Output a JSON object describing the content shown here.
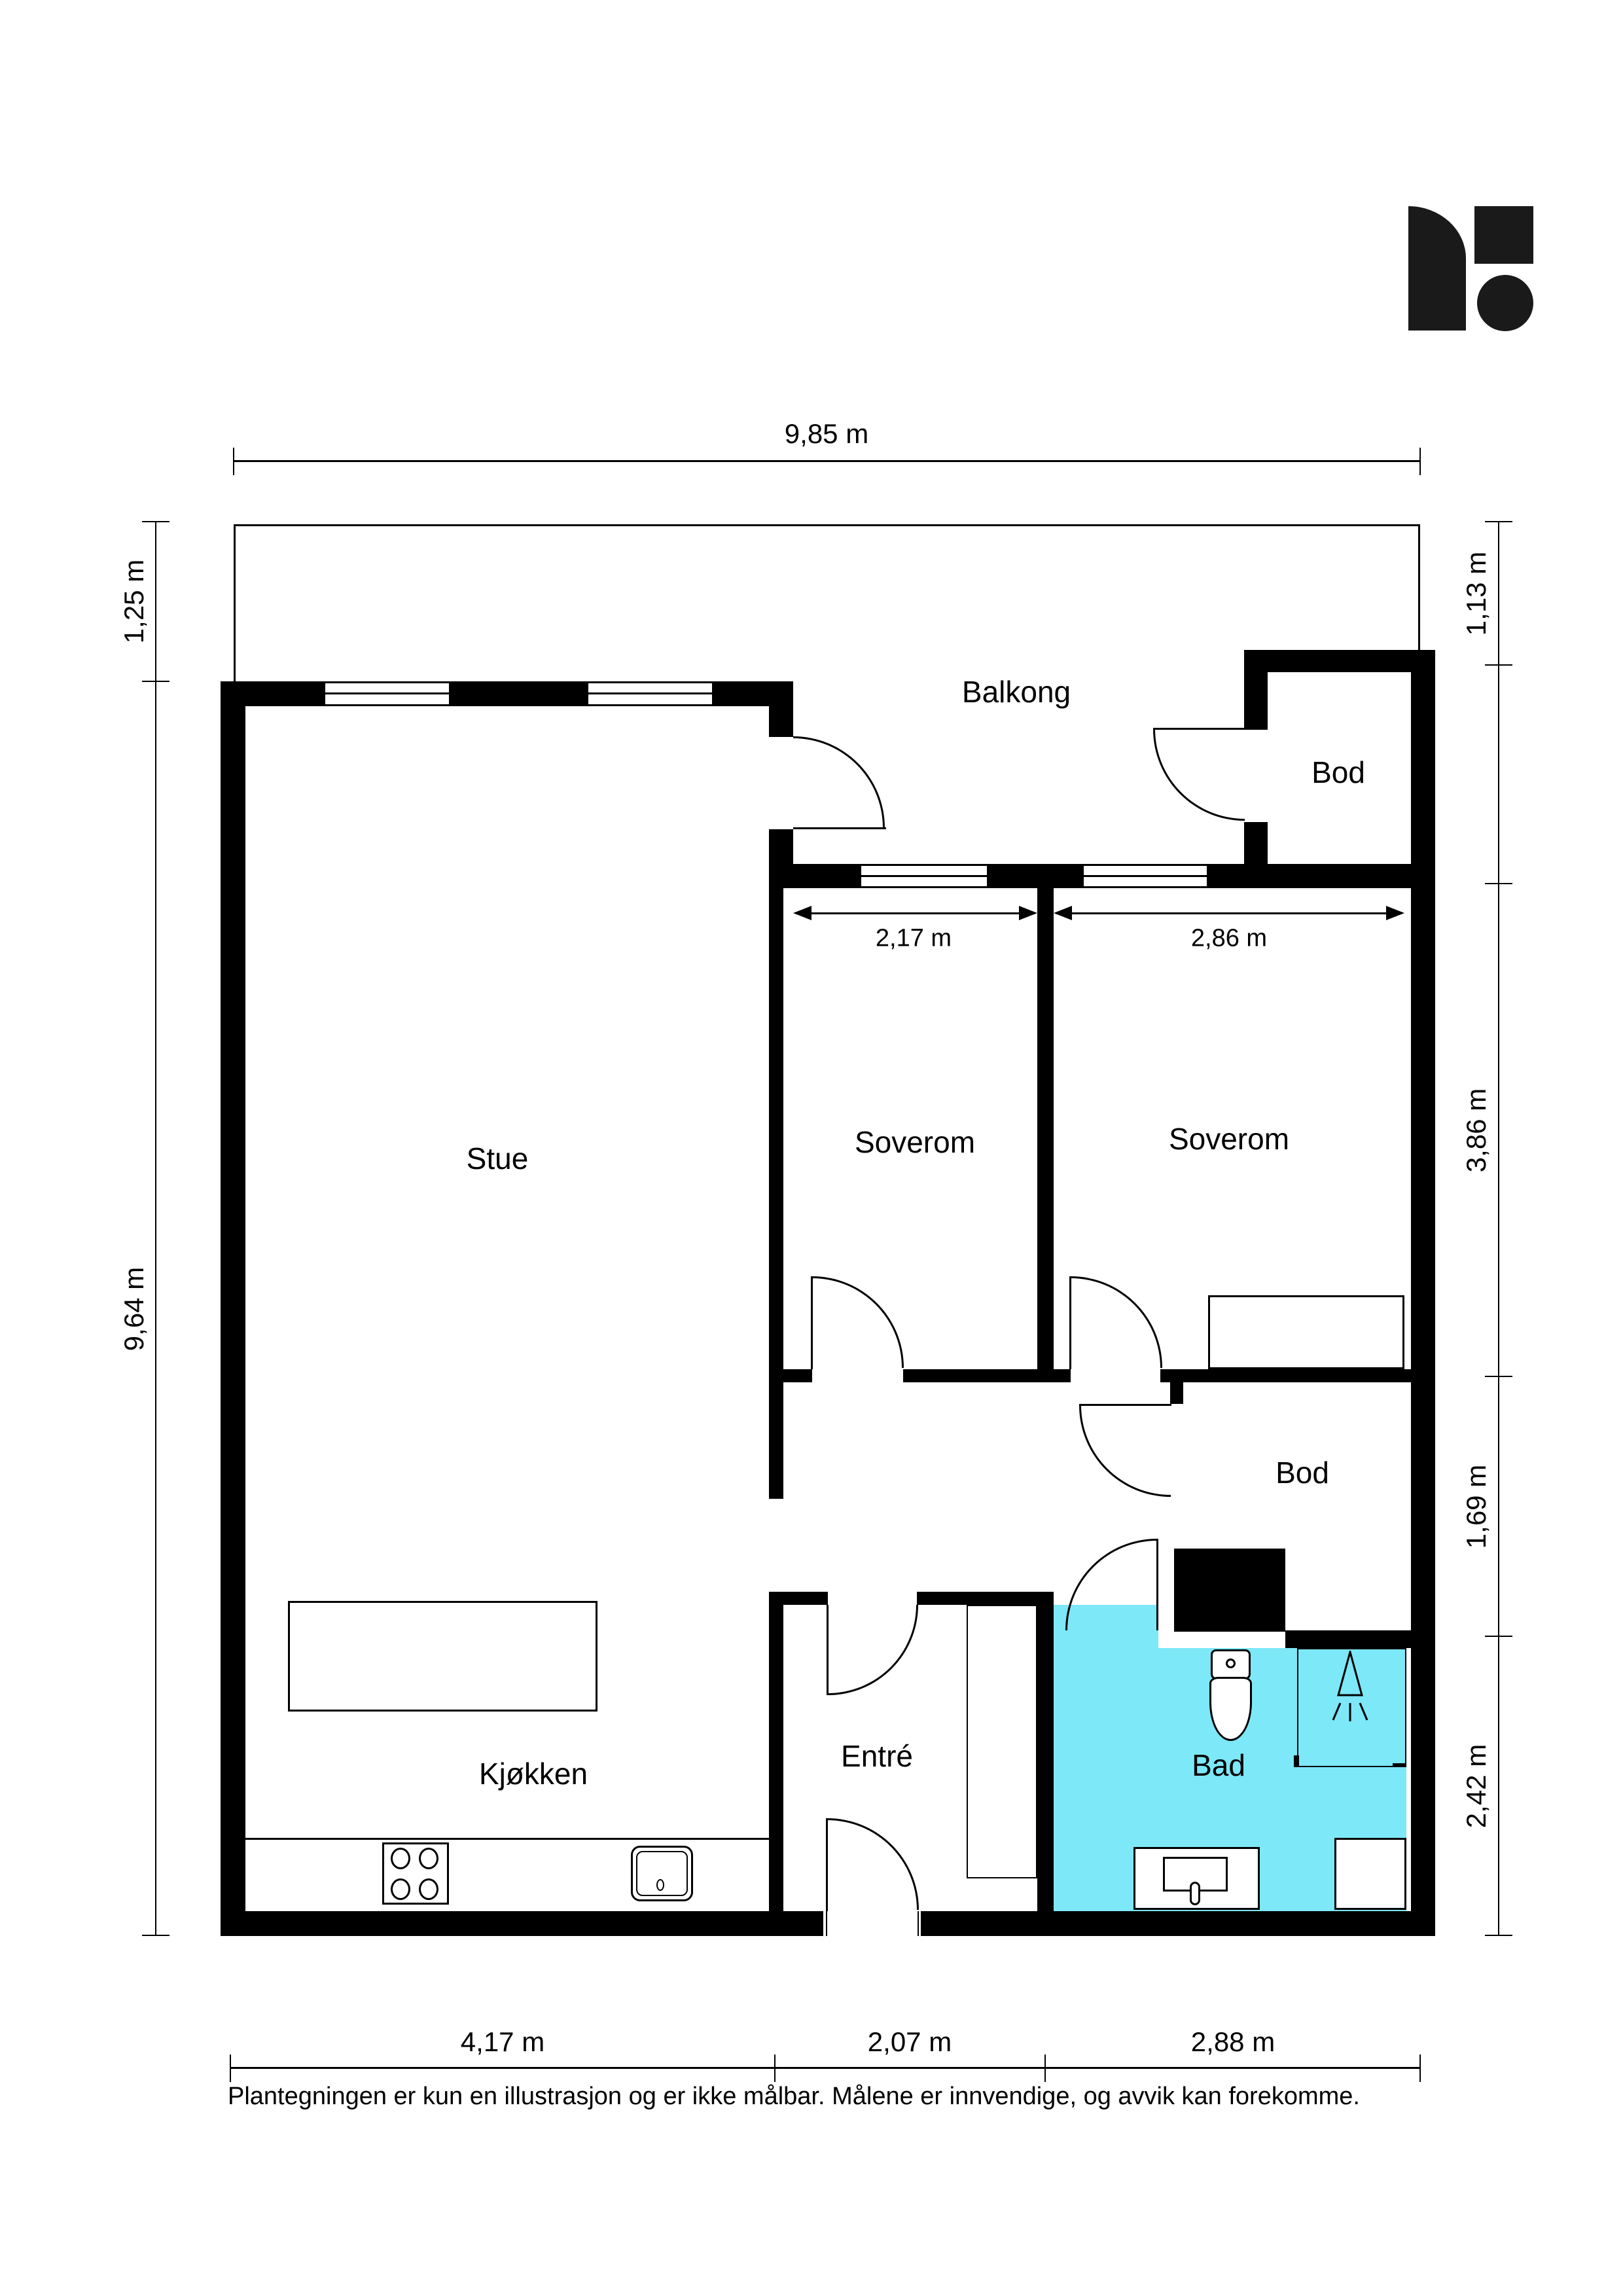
{
  "meta": {
    "document_type": "floor-plan",
    "language": "no"
  },
  "colors": {
    "wall": "#000000",
    "bathroom_fill": "#7DE8F8",
    "background": "#FFFFFF",
    "line": "#000000"
  },
  "logo": {
    "name": "brand-logo",
    "shapes": [
      "rounded-sail",
      "square",
      "circle"
    ],
    "color": "#1a1a1a"
  },
  "rooms": {
    "balkong": {
      "label": "Balkong"
    },
    "bod_top": {
      "label": "Bod"
    },
    "stue": {
      "label": "Stue"
    },
    "soverom1": {
      "label": "Soverom"
    },
    "soverom2": {
      "label": "Soverom"
    },
    "bod_middle": {
      "label": "Bod"
    },
    "entre": {
      "label": "Entré"
    },
    "kjokken": {
      "label": "Kjøkken"
    },
    "bad": {
      "label": "Bad"
    }
  },
  "dimensions": {
    "top": {
      "width_label": "9,85 m"
    },
    "left": {
      "balcony_depth_label": "1,25 m",
      "house_height_label": "9,64 m"
    },
    "right": {
      "seg1_label": "1,13 m",
      "seg2_label": "3,86 m",
      "seg3_label": "1,69 m",
      "seg4_label": "2,42 m"
    },
    "bottom": {
      "seg1_label": "4,17 m",
      "seg2_label": "2,07 m",
      "seg3_label": "2,88 m"
    },
    "interior": {
      "soverom1_width": "2,17 m",
      "soverom2_width": "2,86 m"
    }
  },
  "footer": {
    "disclaimer": "Plantegningen er kun en illustrasjon og er ikke målbar. Målene er innvendige, og avvik kan forekomme."
  }
}
